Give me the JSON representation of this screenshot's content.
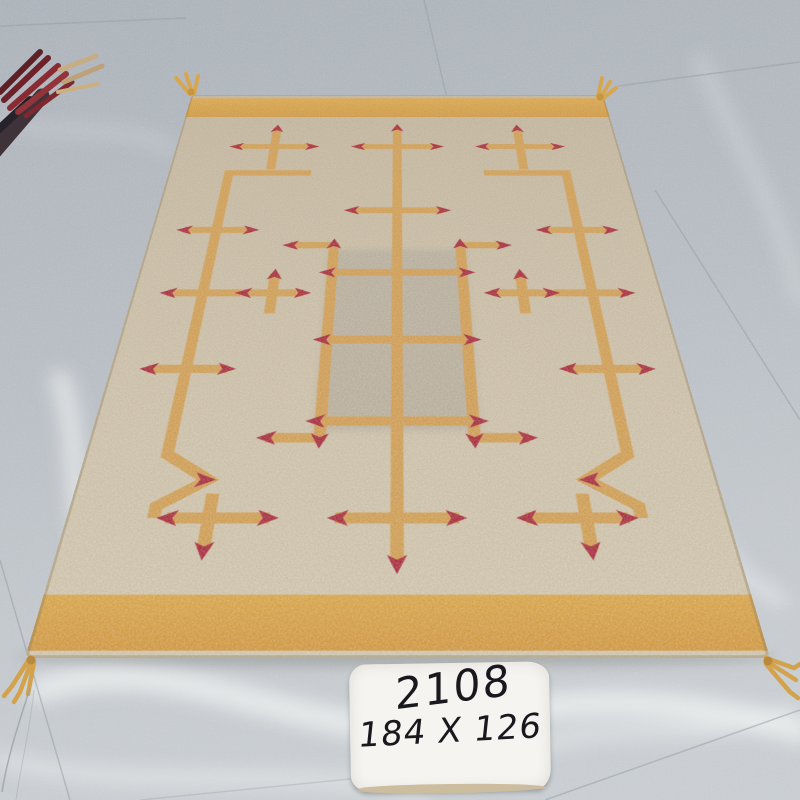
{
  "scene": {
    "type": "photograph",
    "subject": "Handwoven beige kilim rug with mustard geometric pattern and red arrowhead motifs, laid on a gray marble tile floor, with a handwritten inventory card"
  },
  "label_card": {
    "line1": "2108",
    "line2": "184 X 126"
  },
  "rug": {
    "field_color": "#c7bba3",
    "center_panel_color": "#b4ab9b",
    "band_color": "#d49d45",
    "line_color": "#cf9b4f",
    "motif_color": "#a62a3c",
    "tassel_color": "#d2a24c"
  },
  "floor": {
    "tile_color": "#b8bec4",
    "vein_color": "#eef0f0",
    "seam_color": "#959ca4"
  },
  "neighbor_rug": {
    "fringe_colors": [
      "#8a2b33",
      "#3d3338",
      "#c7ad83"
    ]
  }
}
